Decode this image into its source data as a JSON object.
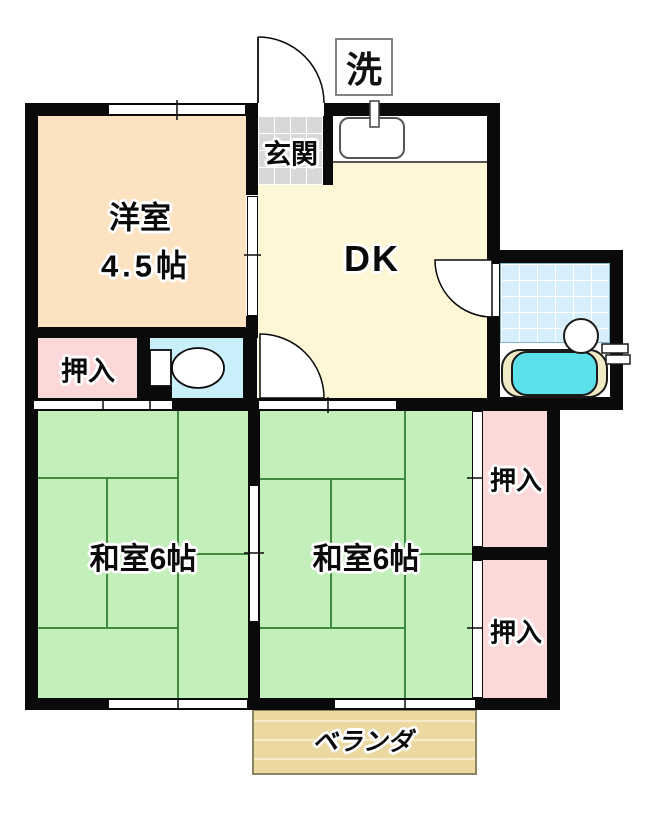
{
  "diagram": {
    "type": "floor-plan",
    "labels": {
      "laundry": "洗",
      "genkan": "玄関",
      "western_room_name": "洋室",
      "western_room_size": "4.5帖",
      "dk": "DK",
      "closet_left": "押入",
      "japanese_room_left": "和室6帖",
      "japanese_room_right": "和室6帖",
      "closet_upper_right": "押入",
      "closet_lower_right": "押入",
      "veranda": "ベランダ"
    },
    "colors": {
      "wall": "#0a0a0a",
      "western_room": "#fbe2c0",
      "dk": "#fdf7d5",
      "genkan_tile": "#d8d8d8",
      "toilet_room": "#c9f0fa",
      "closet_pink": "#fcd8d8",
      "japanese_room": "#c2efba",
      "tatami_line": "#3f8a3f",
      "bath_tile": "#d7effa",
      "bathtub_water": "#5ce1ea",
      "bathtub_rim": "#f0eac5",
      "veranda": "#ecd9a2"
    }
  }
}
